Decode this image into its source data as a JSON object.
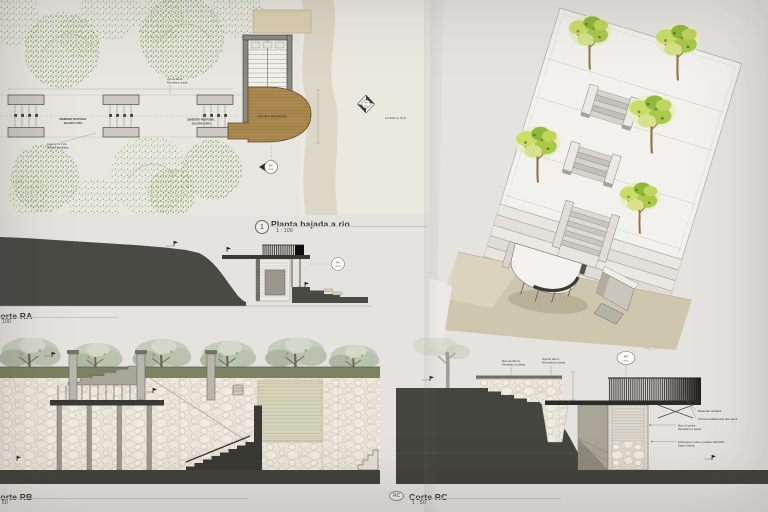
{
  "sheet": {
    "background": "#e4e3df"
  },
  "palette": {
    "deck_wood": "#ac8a4f",
    "terrain_dark": "#4a4a45",
    "olive_ground": "#7d8061",
    "tan_ground": "#cfc7ad",
    "stone": "#e9e5da",
    "plaza": "#f2f1ed",
    "river_band": "#d9d4c2"
  },
  "plan": {
    "number": "1",
    "title": "Planta bajada a rio",
    "scale": "1 : 100",
    "walk_label_line1": "SENDERO PEATONAL",
    "walk_label_line2": "BAJADA A RIO",
    "walk_label2_line1": "SENDERO PEATONAL",
    "walk_label2_line2": "BAJADA A RIO",
    "note_beam_line1": "Viga de 30cms",
    "note_beam_line2": "Revestida en piedra",
    "note_grada_line1": "Grada de 8 x 2 mts",
    "note_grada_line2": "Tablones atornillados",
    "deck_label": "TARIMA MIRADOR",
    "river_label": "CUENCA RIO",
    "marker_a_ref": "RA",
    "marker_a_sheet": "Nº10",
    "marker_b_ref": "RC",
    "marker_b_sheet": "Nº10"
  },
  "corte_ra": {
    "title": "Corte RA",
    "scale": "1 : 100",
    "marker_ref": "RC",
    "marker_sheet": "Nº10"
  },
  "corte_rb": {
    "title": "Corte RB",
    "scale": "1 : 50"
  },
  "corte_rc": {
    "bubble": "RC",
    "title": "Corte RC",
    "scale": "1 : 50",
    "marker_ref": "RA",
    "marker_sheet": "Nº10",
    "ann_railing": "Baranda metálica",
    "ann_deck": "Tarima entablonado tipo deck",
    "ann_wall_line1": "Muro de piedra",
    "ann_wall_line2": "Revestido en piedra",
    "ann_structure_line1": "Estructura en tubos o perfiles 100/100/3",
    "ann_structure_line2": "Según Cálculo",
    "ann_top_wall_line1": "Muro de 30cms",
    "ann_top_wall_line2": "Revestido en piedra",
    "ann_top_beam_line1": "Viga de 30cms",
    "ann_top_beam_line2": "Revestida en piedra"
  }
}
